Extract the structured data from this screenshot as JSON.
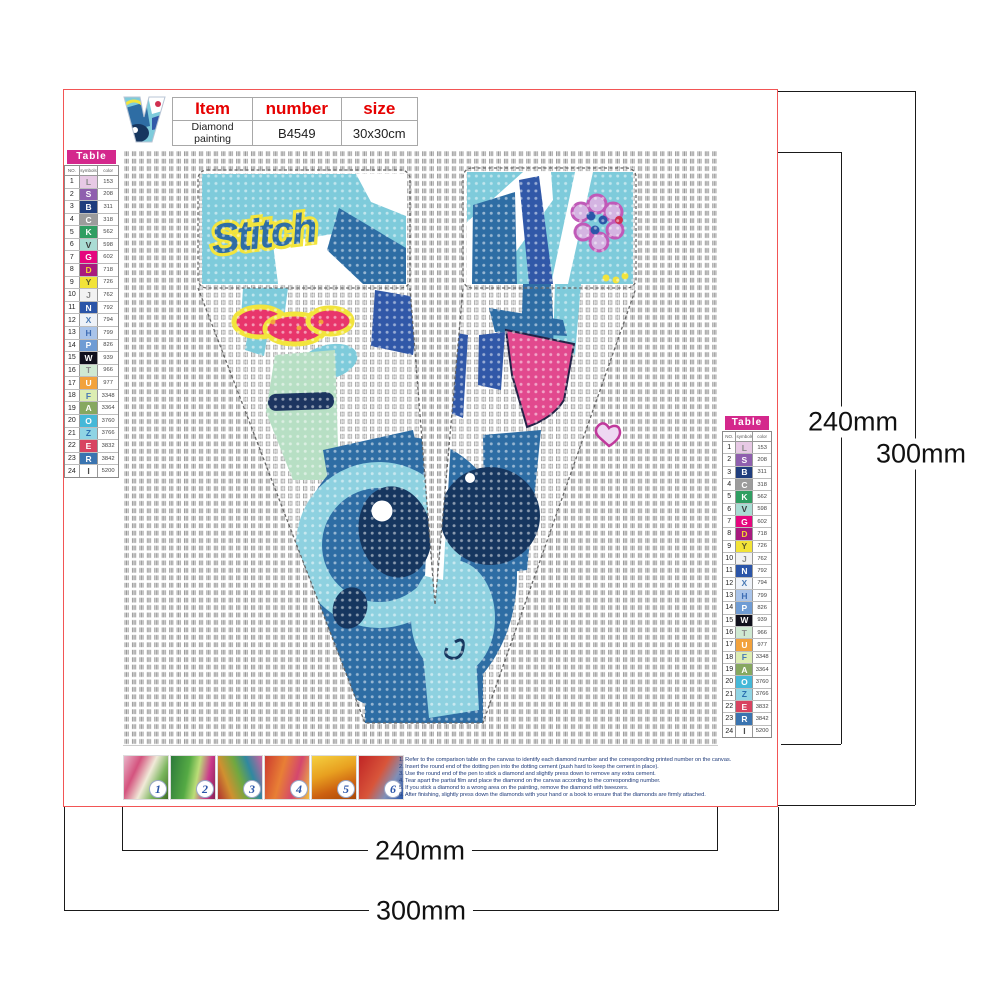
{
  "item_table": {
    "headers": [
      "Item",
      "number",
      "size"
    ],
    "product": "Diamond painting",
    "number": "B4549",
    "size": "30x30cm"
  },
  "color_table": {
    "title": "Table",
    "columns": [
      "NO.",
      "symbols",
      "color"
    ],
    "rows": [
      {
        "no": 1,
        "symbol": "L",
        "code": "153",
        "bg": "#e7c9e5",
        "fg": "#8a8a8a"
      },
      {
        "no": 2,
        "symbol": "S",
        "code": "208",
        "bg": "#8f5fae",
        "fg": "#ffffff"
      },
      {
        "no": 3,
        "symbol": "B",
        "code": "311",
        "bg": "#1f3d7d",
        "fg": "#ffffff"
      },
      {
        "no": 4,
        "symbol": "C",
        "code": "318",
        "bg": "#9c9c9c",
        "fg": "#ffffff"
      },
      {
        "no": 5,
        "symbol": "K",
        "code": "562",
        "bg": "#2f9e62",
        "fg": "#ffffff"
      },
      {
        "no": 6,
        "symbol": "V",
        "code": "598",
        "bg": "#aadcd4",
        "fg": "#3a3a3a"
      },
      {
        "no": 7,
        "symbol": "G",
        "code": "602",
        "bg": "#e5067e",
        "fg": "#ffffff"
      },
      {
        "no": 8,
        "symbol": "D",
        "code": "718",
        "bg": "#a81a7e",
        "fg": "#f5d431"
      },
      {
        "no": 9,
        "symbol": "Y",
        "code": "726",
        "bg": "#f2e337",
        "fg": "#5a5a2a"
      },
      {
        "no": 10,
        "symbol": "J",
        "code": "762",
        "bg": "#f2f2f2",
        "fg": "#8a8a8a"
      },
      {
        "no": 11,
        "symbol": "N",
        "code": "792",
        "bg": "#2b55a8",
        "fg": "#ffffff"
      },
      {
        "no": 12,
        "symbol": "X",
        "code": "794",
        "bg": "#eef2f8",
        "fg": "#4a7ab5"
      },
      {
        "no": 13,
        "symbol": "H",
        "code": "799",
        "bg": "#a9c4ea",
        "fg": "#3d6db5"
      },
      {
        "no": 14,
        "symbol": "P",
        "code": "826",
        "bg": "#6f9cd4",
        "fg": "#ffffff"
      },
      {
        "no": 15,
        "symbol": "W",
        "code": "939",
        "bg": "#10101c",
        "fg": "#ffffff"
      },
      {
        "no": 16,
        "symbol": "T",
        "code": "966",
        "bg": "#cfe9d2",
        "fg": "#8a8a8a"
      },
      {
        "no": 17,
        "symbol": "U",
        "code": "977",
        "bg": "#f2a23c",
        "fg": "#ffffff"
      },
      {
        "no": 18,
        "symbol": "F",
        "code": "3348",
        "bg": "#dcedb2",
        "fg": "#4a7ab5"
      },
      {
        "no": 19,
        "symbol": "A",
        "code": "3364",
        "bg": "#86a860",
        "fg": "#ffffff"
      },
      {
        "no": 20,
        "symbol": "O",
        "code": "3760",
        "bg": "#45b8d8",
        "fg": "#ffffff"
      },
      {
        "no": 21,
        "symbol": "Z",
        "code": "3766",
        "bg": "#8fd4e4",
        "fg": "#2b6fb0"
      },
      {
        "no": 22,
        "symbol": "E",
        "code": "3832",
        "bg": "#d84360",
        "fg": "#ffffff"
      },
      {
        "no": 23,
        "symbol": "R",
        "code": "3842",
        "bg": "#3a74b0",
        "fg": "#ffffff"
      },
      {
        "no": 24,
        "symbol": "I",
        "code": "5200",
        "bg": "#ffffff",
        "fg": "#4a4a4a"
      }
    ]
  },
  "dimensions": {
    "right_inner": "240mm",
    "right_outer": "300mm",
    "bottom_inner": "240mm",
    "bottom_outer": "300mm"
  },
  "steps": {
    "numbers": [
      "1",
      "2",
      "3",
      "4",
      "5",
      "6"
    ]
  },
  "instructions": [
    "1. Refer to the comparison table on the canvas to identify each diamond number and the corresponding printed number on the canvas.",
    "2. Insert the round end of the dotting pen into the dotting cement (push hard to keep the cement in place).",
    "3. Use the round end of the pen to stick a diamond and slightly press down to remove any extra cement.",
    "4. Tear apart the partial film and place the diamond on the canvas according to the corresponding number.",
    "5. If you stick a diamond to a wrong area on the painting, remove the diamond with tweezers.",
    "6. After finishing, slightly press down the diamonds with your hand or a book to ensure that the diamonds are firmly attached."
  ],
  "artwork": {
    "letter": "V",
    "graffiti_text": "Stitch",
    "palette": {
      "teal": "#7ecbdb",
      "steel_blue": "#2e6da4",
      "royal_blue": "#3158a8",
      "navy": "#16365f",
      "pink": "#e2498e",
      "crimson": "#e8356b",
      "yellow": "#f2e43c",
      "mint": "#b7dfc4",
      "purple": "#c05ab8"
    }
  },
  "colors": {
    "accent_red": "#e60000",
    "table_header_bg": "#d4288c",
    "frame_red": "#f25555",
    "instruction_text": "#26417e"
  }
}
